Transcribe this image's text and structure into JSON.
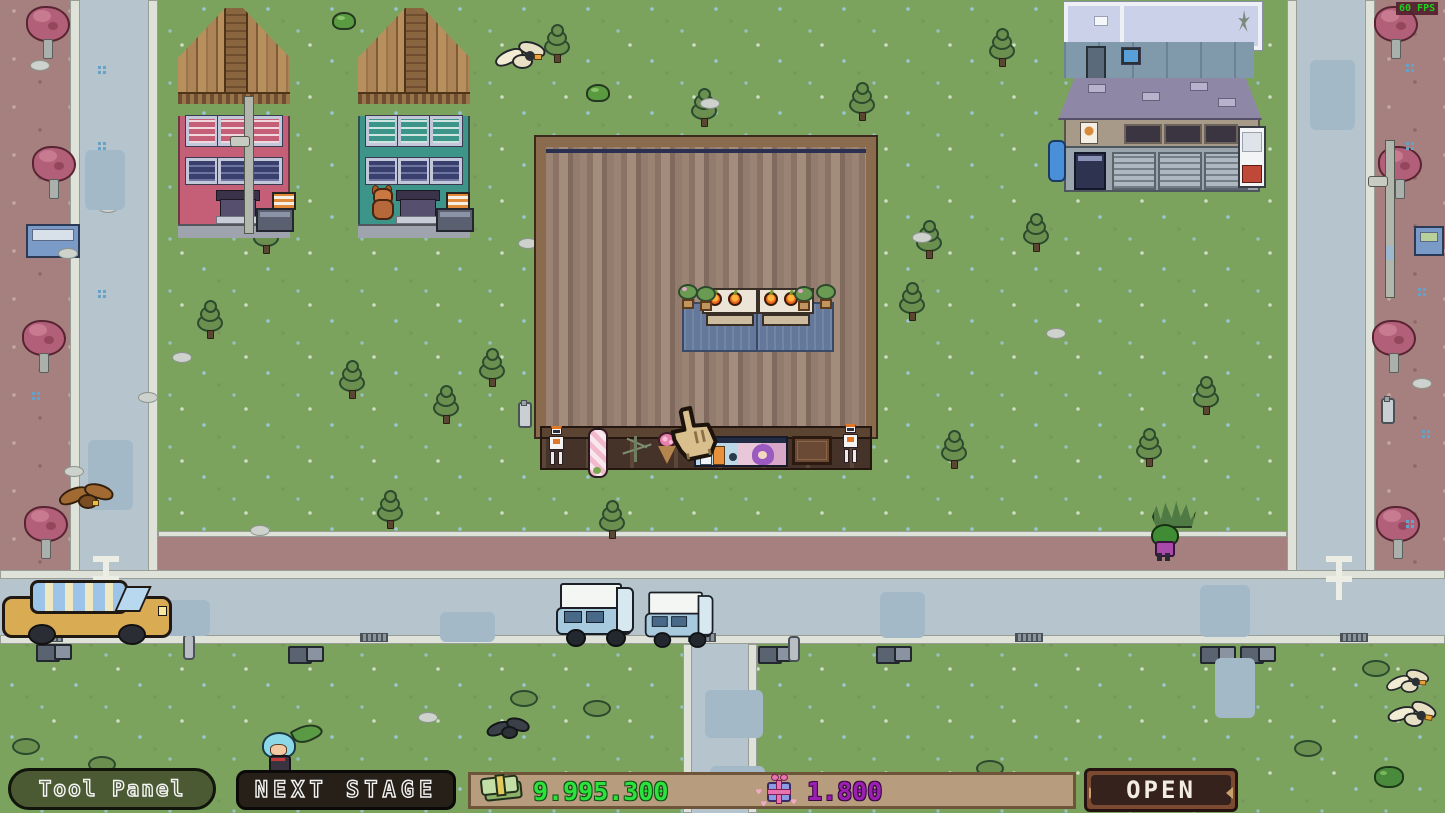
{
  "hud": {
    "tool_panel_label": "Tool Panel",
    "next_stage_label": "NEXT STAGE",
    "money_value": "9.995.300",
    "hearts_value": "1.800",
    "open_label": "OPEN",
    "fps_label": "60 FPS"
  },
  "icons": {
    "money": "money-bills-icon",
    "hearts": "gift-icon",
    "cursor": "hand-cursor-icon",
    "heart_glyph": "♥"
  },
  "colors": {
    "money_text": "#2ce23c",
    "hearts_text": "#9b1fb2",
    "fps_text": "#1bd11b",
    "grass": "#7ca35e",
    "sidewalk": "#a5807e",
    "road": "#b6c4ce",
    "shop_floor_base": "#97806f",
    "hud_bar_bg": "#b79d7e",
    "tool_panel_bg": "#4b5a33",
    "next_stage_bg": "#262019",
    "open_button_bg": "#35221c"
  }
}
